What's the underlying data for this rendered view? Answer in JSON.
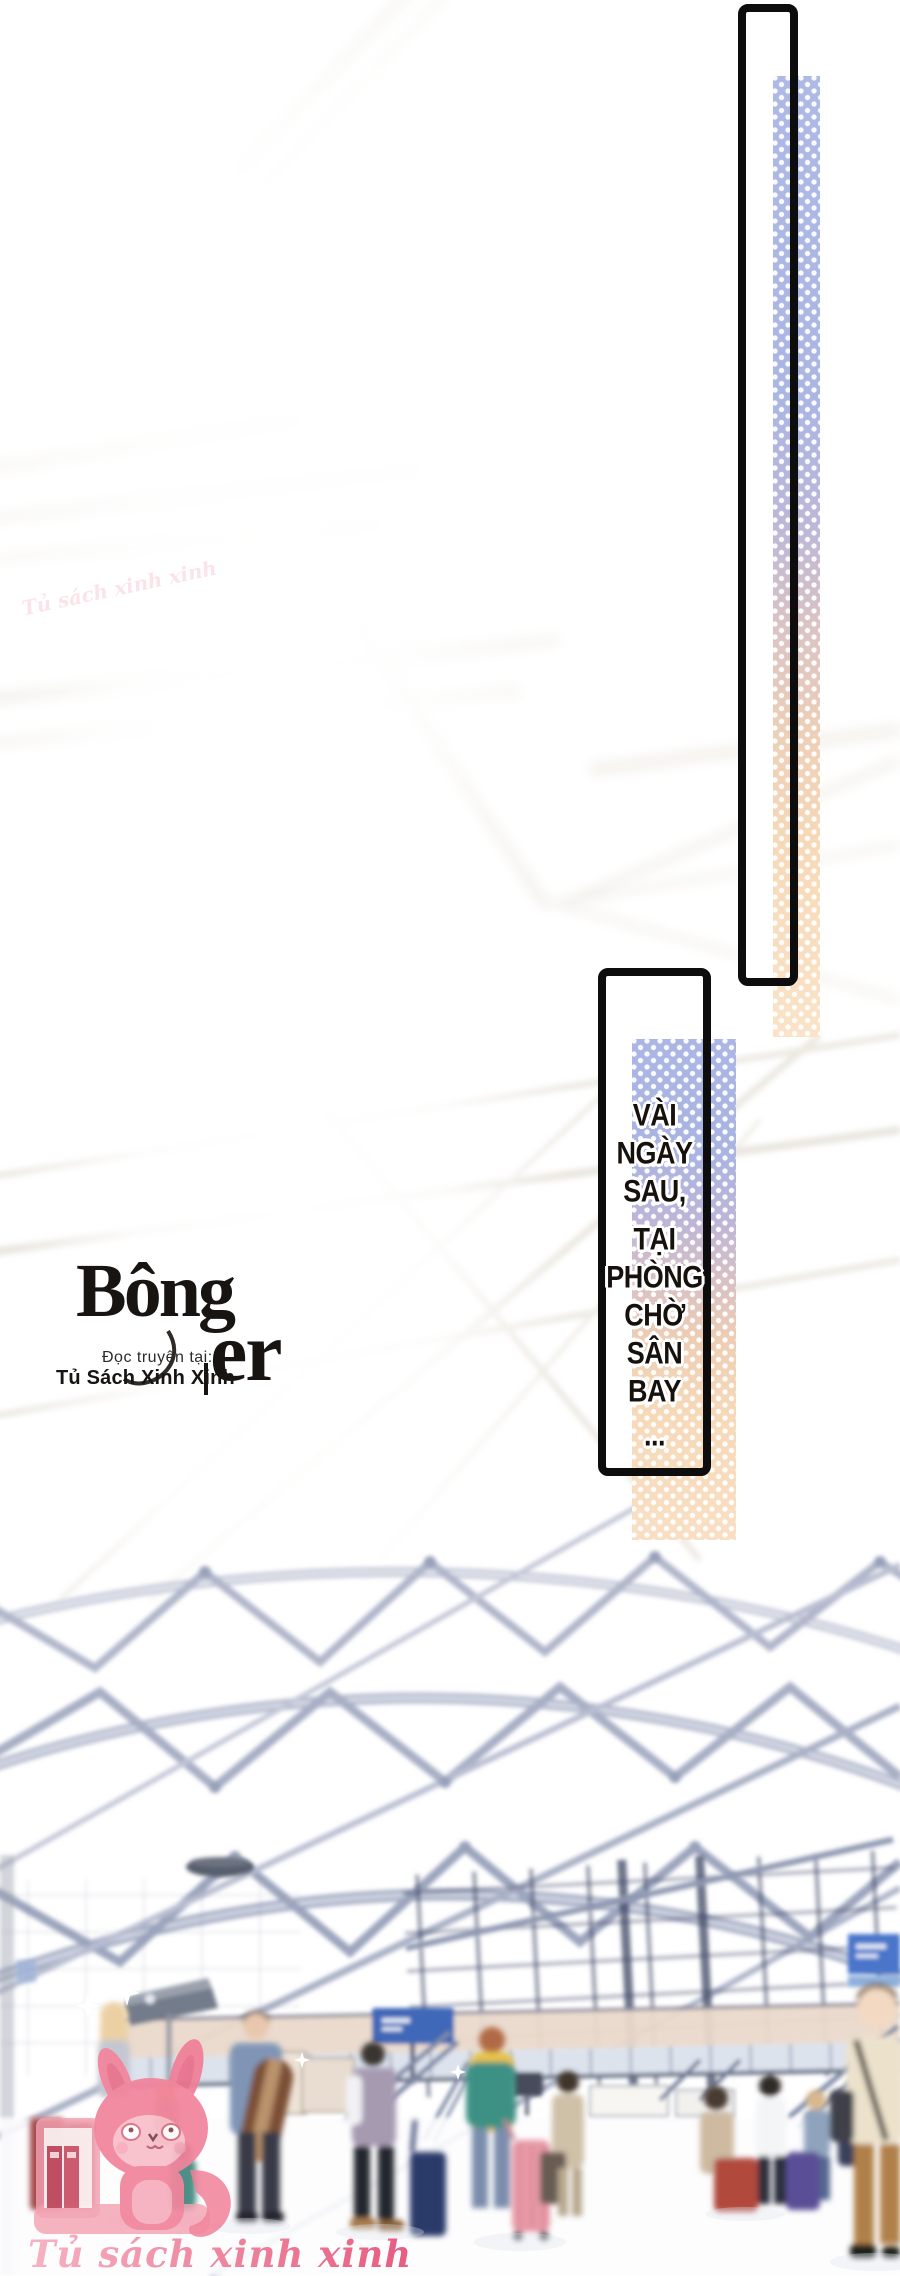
{
  "page": {
    "width": 900,
    "height": 2276,
    "background": "#ffffff"
  },
  "panels": {
    "border_color": "#0d0d0d",
    "tall_panel": {
      "x": 738,
      "y": 4,
      "width": 60,
      "height": 982
    },
    "caption_panel": {
      "x": 598,
      "y": 968,
      "width": 113,
      "height": 508
    }
  },
  "caption": {
    "lines": [
      "VÀI",
      "NGÀY",
      "SAU,",
      "TẠI",
      "PHÒNG",
      "CHỜ",
      "SÂN",
      "BAY",
      "..."
    ],
    "text_color": "#16110d",
    "outline_color": "#ffffff"
  },
  "strips": {
    "dot_color": "#ffffff",
    "blue": "#abb6e4",
    "lavender": "#c9bcd4",
    "peach": "#f6d9b9",
    "cream": "#fae3c8"
  },
  "logo": {
    "title_main": "Bông",
    "title_suffix": "er",
    "tagline": "Đọc truyện tại:",
    "site_name": "Tủ Sách Xinh Xinh",
    "divider_bar": "",
    "color": "#181411"
  },
  "watermarks": {
    "side_text": "Tủ sách xinh xinh",
    "mascot_caption": "Tủ sách xinh xinh",
    "pink": "#ee7d9a"
  },
  "scene": {
    "sign_blue": "#4167b8",
    "truss_color": "#a3abc2",
    "mezzanine_color": "#ead9cb",
    "mascot_pink": "#f2849c"
  }
}
